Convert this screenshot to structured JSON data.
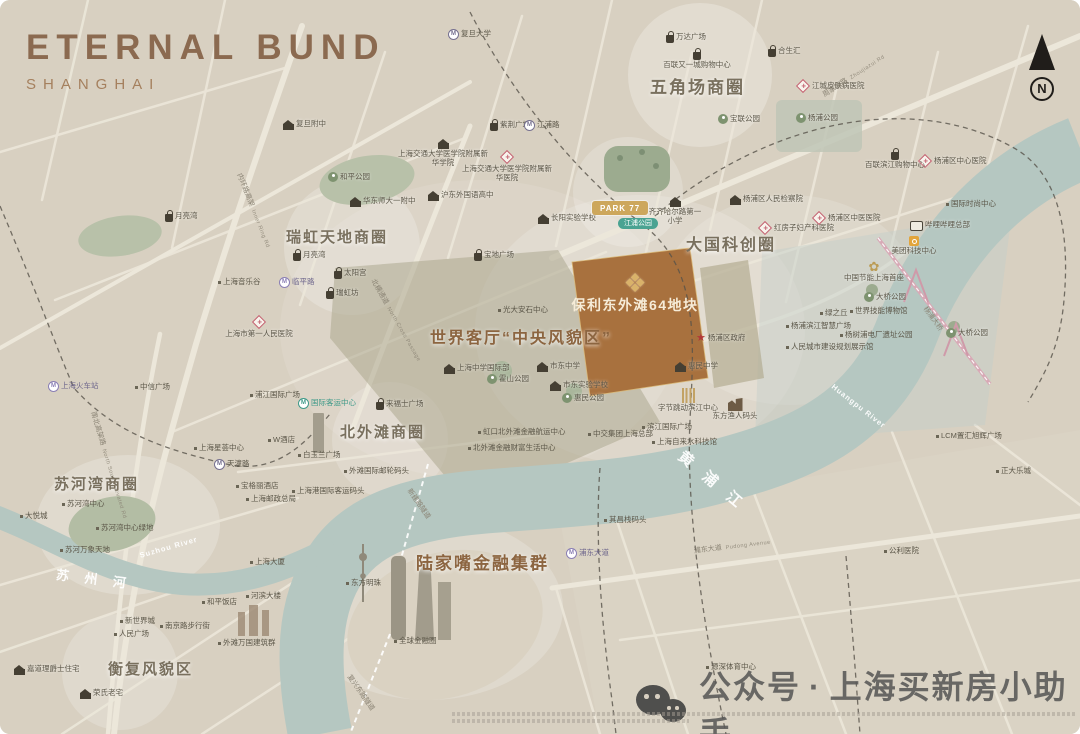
{
  "title": {
    "main": "ETERNAL BUND",
    "sub": "SHANGHAI"
  },
  "compass": {
    "letter": "N"
  },
  "watermark": {
    "account_label": "公众号",
    "separator": "·",
    "account_name": "上海买新房小助手"
  },
  "colors": {
    "background": "#d8d0c1",
    "river": "#b5c7c1",
    "parcel": "#a8713e",
    "accent_brown": "#8c6540",
    "gold": "#cda75c",
    "bridge_pink": "#d8a9b6"
  },
  "map": {
    "project": {
      "name": "保利东外滩64地块"
    },
    "labels": [
      {
        "k": "poi",
        "i": "school",
        "t": "复旦附中",
        "x": 283,
        "y": 119
      },
      {
        "k": "metro",
        "i": "m",
        "t": "复旦大学",
        "x": 448,
        "y": 29
      },
      {
        "k": "poi",
        "i": "bag",
        "t": "紫荆广场",
        "x": 490,
        "y": 119
      },
      {
        "k": "poi",
        "i": "bag",
        "t": "万达广场",
        "x": 666,
        "y": 31
      },
      {
        "k": "poi",
        "i": "bag",
        "t": "百联又一城购物中心",
        "x": 655,
        "y": 48,
        "st": 1,
        "w": 84
      },
      {
        "k": "district",
        "t": "五角场商圈",
        "x": 650,
        "y": 78,
        "s": 17
      },
      {
        "k": "poi",
        "i": "bag",
        "t": "合生汇",
        "x": 768,
        "y": 45
      },
      {
        "k": "poi",
        "i": "hosp",
        "t": "江城皮肤病医院",
        "x": 796,
        "y": 79
      },
      {
        "k": "metro",
        "i": "m",
        "t": "江浦路",
        "x": 524,
        "y": 120
      },
      {
        "k": "poi",
        "i": "park",
        "t": "宝联公园",
        "x": 718,
        "y": 114
      },
      {
        "k": "poi",
        "i": "park",
        "t": "杨浦公园",
        "x": 796,
        "y": 113
      },
      {
        "k": "poi",
        "i": "school",
        "t": "上海交通大学医学院附属新华学院",
        "x": 396,
        "y": 138,
        "st": 1,
        "w": 94
      },
      {
        "k": "poi",
        "i": "hosp",
        "t": "上海交通大学医学院附属新华医院",
        "x": 462,
        "y": 150,
        "st": 1,
        "w": 90
      },
      {
        "k": "poi",
        "i": "park",
        "t": "和平公园",
        "x": 328,
        "y": 172
      },
      {
        "k": "poi",
        "i": "school",
        "t": "华东师大一附中",
        "x": 350,
        "y": 196
      },
      {
        "k": "poi",
        "i": "school",
        "t": "沪东外国语高中",
        "x": 428,
        "y": 190
      },
      {
        "k": "poi",
        "i": "school",
        "t": "长阳实验学校",
        "x": 538,
        "y": 213
      },
      {
        "k": "pillg",
        "t": "PARK 77",
        "x": 592,
        "y": 201,
        "n": "park77-badge"
      },
      {
        "k": "pillt",
        "t": "江浦公园",
        "x": 618,
        "y": 218,
        "n": "metro-station-jiangpu-park"
      },
      {
        "k": "poi",
        "i": "school",
        "t": "齐齐哈尔路第一小学",
        "x": 646,
        "y": 196,
        "st": 1,
        "w": 58
      },
      {
        "k": "poi",
        "i": "gov",
        "t": "杨浦区人民检察院",
        "x": 730,
        "y": 194
      },
      {
        "k": "poi",
        "i": "hosp",
        "t": "红房子妇产科医院",
        "x": 758,
        "y": 221
      },
      {
        "k": "poi",
        "i": "hosp",
        "t": "杨浦区中医医院",
        "x": 812,
        "y": 211
      },
      {
        "k": "poi",
        "i": "hosp",
        "t": "杨浦区中心医院",
        "x": 918,
        "y": 154
      },
      {
        "k": "poi",
        "i": "bag",
        "t": "百联滨江购物中心",
        "x": 864,
        "y": 148,
        "st": 1,
        "w": 62
      },
      {
        "k": "txt",
        "t": "国际时尚中心",
        "x": 946,
        "y": 200
      },
      {
        "k": "poi",
        "i": "bili",
        "t": "哔哩哔哩总部",
        "x": 910,
        "y": 219
      },
      {
        "k": "poi",
        "i": "mei",
        "t": "美团科技中心",
        "x": 884,
        "y": 236,
        "st": 1,
        "w": 60
      },
      {
        "k": "poi",
        "i": "flo",
        "t": "中国节能上海首座",
        "x": 838,
        "y": 260,
        "st": 1,
        "w": 72
      },
      {
        "k": "district",
        "t": "大国科创圈",
        "x": 686,
        "y": 237,
        "s": 16
      },
      {
        "k": "poi",
        "i": "park",
        "t": "大桥公园",
        "x": 864,
        "y": 292
      },
      {
        "k": "poi",
        "i": "park",
        "t": "大桥公园",
        "x": 946,
        "y": 328
      },
      {
        "k": "txt",
        "t": "绿之丘",
        "x": 820,
        "y": 309
      },
      {
        "k": "txt",
        "t": "世界技能博物馆",
        "x": 850,
        "y": 307
      },
      {
        "k": "txt",
        "t": "杨浦滨江智慧广场",
        "x": 786,
        "y": 322
      },
      {
        "k": "txt",
        "t": "杨树浦电厂遗址公园",
        "x": 840,
        "y": 331
      },
      {
        "k": "txt",
        "t": "人民城市建设规划展示馆",
        "x": 786,
        "y": 343
      },
      {
        "k": "district",
        "t": "瑞虹天地商圈",
        "x": 286,
        "y": 229,
        "s": 15
      },
      {
        "k": "poi",
        "i": "bag",
        "t": "月亮湾",
        "x": 165,
        "y": 210
      },
      {
        "k": "poi",
        "i": "bag",
        "t": "月亮湾",
        "x": 293,
        "y": 249
      },
      {
        "k": "metro",
        "i": "mp",
        "t": "临平路",
        "x": 279,
        "y": 277,
        "c": "purple"
      },
      {
        "k": "txt",
        "t": "上海音乐谷",
        "x": 218,
        "y": 278
      },
      {
        "k": "poi",
        "i": "bag",
        "t": "太阳宫",
        "x": 334,
        "y": 267
      },
      {
        "k": "poi",
        "i": "bag",
        "t": "瑞虹坊",
        "x": 326,
        "y": 287
      },
      {
        "k": "poi",
        "i": "bag",
        "t": "宝地广场",
        "x": 474,
        "y": 249
      },
      {
        "k": "txt",
        "t": "光大安石中心",
        "x": 498,
        "y": 306
      },
      {
        "k": "poi",
        "i": "hosp",
        "t": "上海市第一人民医院",
        "x": 220,
        "y": 315,
        "st": 1,
        "w": 78
      },
      {
        "k": "district",
        "t": "世界客厅“中央风貌区”",
        "x": 430,
        "y": 330,
        "s": 16,
        "c": "brown"
      },
      {
        "k": "poi",
        "i": "school",
        "t": "上海中学国际部",
        "x": 444,
        "y": 363
      },
      {
        "k": "poi",
        "i": "park",
        "t": "霍山公园",
        "x": 487,
        "y": 374
      },
      {
        "k": "poi",
        "i": "school",
        "t": "市东中学",
        "x": 537,
        "y": 361
      },
      {
        "k": "poi",
        "i": "school",
        "t": "市东实验学校",
        "x": 550,
        "y": 380
      },
      {
        "k": "poi",
        "i": "park",
        "t": "惠民公园",
        "x": 562,
        "y": 393
      },
      {
        "k": "poi",
        "i": "school",
        "t": "惠民中学",
        "x": 675,
        "y": 361
      },
      {
        "k": "poi",
        "i": "star",
        "t": "杨浦区政府",
        "x": 696,
        "y": 333
      },
      {
        "k": "proj",
        "i": "clover",
        "t": "保利东外滩64地块",
        "x": 565,
        "y": 270,
        "st": 1,
        "w": 140,
        "n": "project-parcel-label"
      },
      {
        "k": "poi",
        "i": "bars",
        "t": "字节跳动滨江中心",
        "x": 652,
        "y": 388,
        "st": 1,
        "w": 72
      },
      {
        "k": "poi",
        "i": "bldg",
        "t": "东方渔人码头",
        "x": 706,
        "y": 398,
        "st": 1,
        "w": 58
      },
      {
        "k": "txt",
        "t": "滨江国际广场",
        "x": 642,
        "y": 423
      },
      {
        "k": "txt",
        "t": "中交集团上海总部",
        "x": 588,
        "y": 430
      },
      {
        "k": "txt",
        "t": "上海自来水科技馆",
        "x": 652,
        "y": 438
      },
      {
        "k": "txt",
        "t": "其昌栈码头",
        "x": 604,
        "y": 516
      },
      {
        "k": "txt",
        "t": "LCM置汇旭辉广场",
        "x": 936,
        "y": 432
      },
      {
        "k": "txt",
        "t": "正大乐城",
        "x": 996,
        "y": 467
      },
      {
        "k": "txt",
        "t": "公利医院",
        "x": 884,
        "y": 547
      },
      {
        "k": "txt",
        "t": "源深体育中心",
        "x": 706,
        "y": 663
      },
      {
        "k": "metro",
        "i": "mp",
        "t": "浦东大道",
        "x": 566,
        "y": 548,
        "c": "purple"
      },
      {
        "k": "road",
        "t": "浦东大道",
        "en": "Pudong Avenue",
        "x": 694,
        "y": 548,
        "r": -7
      },
      {
        "k": "road",
        "t": "周家嘴路",
        "en": "Zhoujiazui Rd",
        "x": 824,
        "y": 92,
        "r": -33
      },
      {
        "k": "road",
        "t": "内环路高架",
        "en": "Inner Ring Rd",
        "x": 238,
        "y": 170,
        "r": 68
      },
      {
        "k": "road",
        "t": "北横通道",
        "en": "North Cross Passage",
        "x": 372,
        "y": 276,
        "r": 60
      },
      {
        "k": "road",
        "t": "南北高架路",
        "en": "North South Elevated Rd",
        "x": 92,
        "y": 408,
        "r": 73
      },
      {
        "k": "road",
        "t": "新建路隧道",
        "x": 408,
        "y": 486,
        "r": 55
      },
      {
        "k": "road",
        "t": "复兴东路隧道",
        "x": 348,
        "y": 672,
        "r": 55
      },
      {
        "k": "road",
        "t": "杨浦大桥",
        "x": 924,
        "y": 304,
        "r": 54
      },
      {
        "k": "district",
        "t": "北外滩商圈",
        "x": 340,
        "y": 424,
        "s": 15
      },
      {
        "k": "metro",
        "i": "mt",
        "t": "国际客运中心",
        "x": 298,
        "y": 398,
        "c": "teal"
      },
      {
        "k": "txt",
        "t": "中信广场",
        "x": 135,
        "y": 383
      },
      {
        "k": "txt",
        "t": "浦江国际广场",
        "x": 250,
        "y": 391
      },
      {
        "k": "metro",
        "i": "mp",
        "t": "上海火车站",
        "x": 48,
        "y": 381,
        "c": "purple"
      },
      {
        "k": "metro",
        "i": "m",
        "t": "天潼路",
        "x": 214,
        "y": 459
      },
      {
        "k": "txt",
        "t": "上海星荟中心",
        "x": 194,
        "y": 444
      },
      {
        "k": "txt",
        "t": "W酒店",
        "x": 268,
        "y": 436
      },
      {
        "k": "txt",
        "t": "白玉兰广场",
        "x": 298,
        "y": 451
      },
      {
        "k": "poi",
        "i": "bag",
        "t": "来福士广场",
        "x": 376,
        "y": 398
      },
      {
        "k": "txt",
        "t": "虹口北外滩金融航运中心",
        "x": 478,
        "y": 428
      },
      {
        "k": "txt",
        "t": "北外滩金融财富生活中心",
        "x": 468,
        "y": 444
      },
      {
        "k": "txt",
        "t": "外滩国际邮轮码头",
        "x": 344,
        "y": 467
      },
      {
        "k": "txt",
        "t": "上海港国际客运码头",
        "x": 292,
        "y": 487
      },
      {
        "k": "txt",
        "t": "宝格丽酒店",
        "x": 236,
        "y": 482
      },
      {
        "k": "txt",
        "t": "上海邮政总局",
        "x": 246,
        "y": 495
      },
      {
        "k": "txt",
        "t": "上海大厦",
        "x": 250,
        "y": 558
      },
      {
        "k": "txt",
        "t": "河滨大楼",
        "x": 246,
        "y": 592
      },
      {
        "k": "txt",
        "t": "和平饭店",
        "x": 202,
        "y": 598
      },
      {
        "k": "txt",
        "t": "外滩万国建筑群",
        "x": 218,
        "y": 639
      },
      {
        "k": "district",
        "t": "苏河湾商圈",
        "x": 54,
        "y": 476,
        "s": 15
      },
      {
        "k": "txt",
        "t": "苏河湾中心",
        "x": 62,
        "y": 500
      },
      {
        "k": "txt",
        "t": "大悦城",
        "x": 20,
        "y": 512
      },
      {
        "k": "txt",
        "t": "苏河湾中心绿地",
        "x": 96,
        "y": 524
      },
      {
        "k": "txt",
        "t": "苏河万象天地",
        "x": 60,
        "y": 546
      },
      {
        "k": "river",
        "t": "苏 州 河",
        "x": 56,
        "y": 568,
        "r": 7,
        "s": 13,
        "n": "suzhou-river-label"
      },
      {
        "k": "river",
        "t": "Suzhou River",
        "x": 140,
        "y": 552,
        "r": -16,
        "s": 7.5,
        "ls": 1,
        "n": "suzhou-river-label-en"
      },
      {
        "k": "txt",
        "t": "新世界城",
        "x": 120,
        "y": 617
      },
      {
        "k": "txt",
        "t": "南京路步行街",
        "x": 160,
        "y": 622
      },
      {
        "k": "txt",
        "t": "人民广场",
        "x": 114,
        "y": 630
      },
      {
        "k": "district",
        "t": "衡复风貌区",
        "x": 108,
        "y": 661,
        "s": 15
      },
      {
        "k": "poi",
        "i": "school",
        "t": "嘉道理爵士住宅",
        "x": 14,
        "y": 664
      },
      {
        "k": "poi",
        "i": "school",
        "t": "荣氏老宅",
        "x": 80,
        "y": 688
      },
      {
        "k": "txt",
        "t": "东方明珠",
        "x": 346,
        "y": 579
      },
      {
        "k": "district",
        "t": "陆家嘴金融集群",
        "x": 416,
        "y": 554,
        "s": 17,
        "c": "brown"
      },
      {
        "k": "txt",
        "t": "全球金融圈",
        "x": 394,
        "y": 637
      },
      {
        "k": "river",
        "t": "黄 浦 江",
        "x": 680,
        "y": 446,
        "r": 40,
        "s": 15,
        "n": "huangpu-river-label"
      },
      {
        "k": "river",
        "t": "Huangpu River",
        "x": 832,
        "y": 382,
        "r": 38,
        "s": 7.5,
        "ls": 1,
        "n": "huangpu-river-label-en"
      }
    ]
  }
}
